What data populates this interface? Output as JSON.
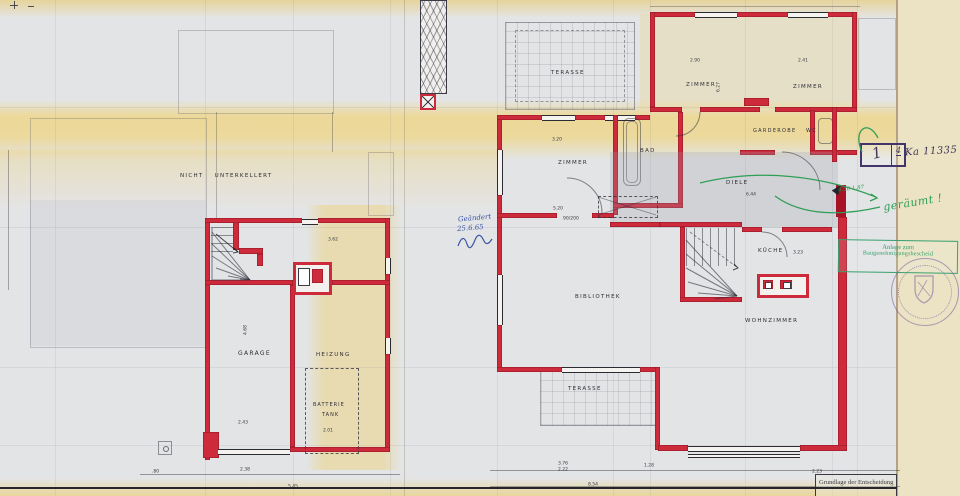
{
  "colors": {
    "wall_red": "#cd2b3c",
    "green": "#2f9e55",
    "blue_ink": "#3c55a5",
    "purple": "#6f5b9c",
    "band_yellow": "#eed98f",
    "cream": "#ece4c6"
  },
  "header": {
    "ref_cell_main": "1",
    "ref_cell_sub": "4",
    "ref_number": "Ka 11335"
  },
  "annotations": {
    "geraeumt": "geräumt !",
    "green_dims": "4.30  1.87",
    "changed_line1": "Geändert",
    "changed_line2": "25.6.65",
    "stamp_line1": "Anlage zum",
    "stamp_line2": "Baugenehmigungsbescheid",
    "title_block": "Grundlage der Entscheidung"
  },
  "left_plan": {
    "note": "NICHT UNTERKELLERT",
    "rooms": {
      "garage": "GARAGE",
      "heizung": "HEIZUNG",
      "tank1": "BATTERIE",
      "tank2": "TANK"
    },
    "dims": {
      "d1": "3.62",
      "d2": "4.68",
      "d3": "2.43",
      "d4": "2.01",
      "d5": ".80",
      "d6": "2.38",
      "d7": "5.45"
    }
  },
  "right_plan": {
    "rooms": {
      "terasse_top": "TERASSE",
      "zimmer_nw": "ZIMMER",
      "zimmer_ne": "ZIMMER",
      "zimmer_w": "ZIMMER",
      "bad": "BAD",
      "garderobe": "GARDEROBE",
      "wc": "WC",
      "diele": "DIELE",
      "kueche": "KÜCHE",
      "bibliothek": "BIBLIOTHEK",
      "wohnzimmer": "WOHNZIMMER",
      "terasse_bottom": "TERASSE"
    },
    "dims": {
      "d1": "3.20",
      "d2": "5.20",
      "d3": "2.90",
      "d4": "2.41",
      "d5": "6.27",
      "d6": "6.44",
      "d7": "3.23",
      "d8": "3.76",
      "d9": "2.22",
      "d10": "1.28",
      "d11": "8.54",
      "d12": "2.23",
      "d13": "90/200"
    }
  }
}
